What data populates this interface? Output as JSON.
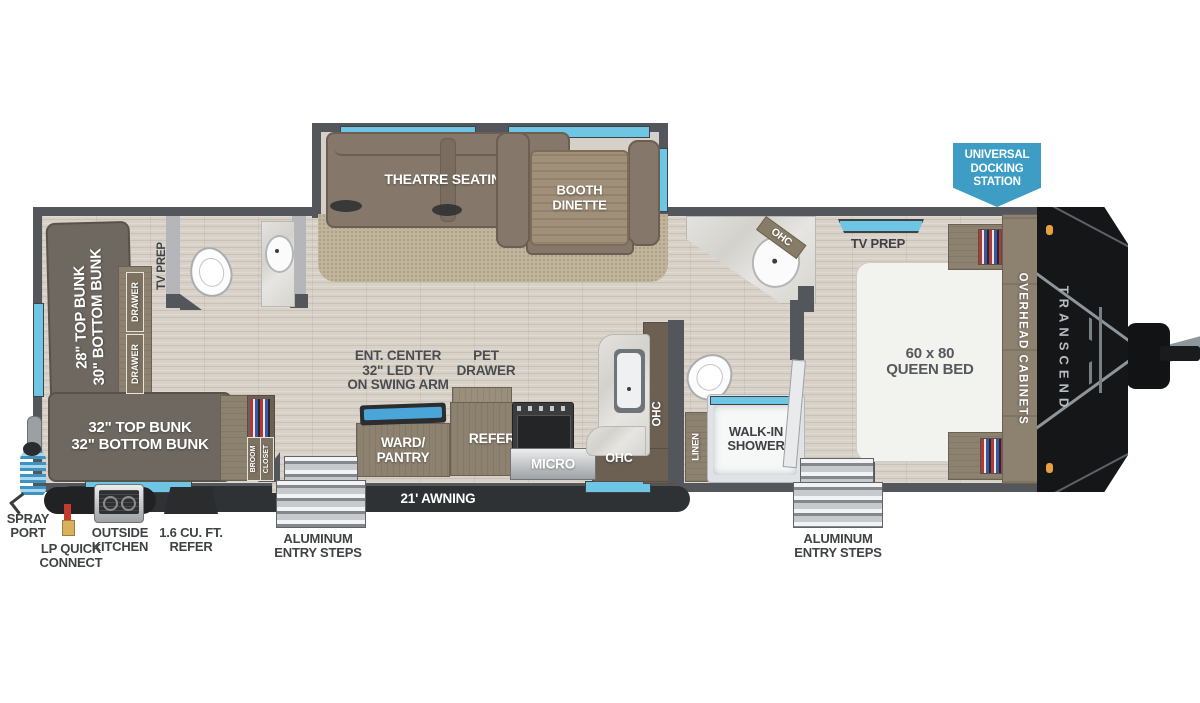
{
  "title": "Transcend travel trailer floor plan",
  "colors": {
    "wall": "#53565a",
    "window_glass": "#6ec6e4",
    "awning_bar": "#2f3235",
    "badge_blue": "#3e9dc4",
    "floor": "#d8d1c8",
    "carpet": "#c0b49b",
    "furniture_brown": "#85786a",
    "label_text": "#3f4245"
  },
  "labels": {
    "theatre": "THEATRE SEATING",
    "dinette_l1": "BOOTH",
    "dinette_l2": "DINETTE",
    "bunk_rear_l1": "28\" TOP BUNK",
    "bunk_rear_l2": "30\" BOTTOM BUNK",
    "drawer_a": "DRAWER",
    "drawer_b": "DRAWER",
    "tv_prep_rear": "TV PREP",
    "bunk32_l1": "32\" TOP BUNK",
    "bunk32_l2": "32\" BOTTOM BUNK",
    "broom": "BROOM",
    "closet": "CLOSET",
    "ent_l1": "ENT. CENTER",
    "ent_l2": "32\" LED TV",
    "ent_l3": "ON SWING ARM",
    "pet_l1": "PET",
    "pet_l2": "DRAWER",
    "ward_l1": "WARD/",
    "ward_l2": "PANTRY",
    "refer": "REFER",
    "micro": "MICRO",
    "ohc_kitchen_side": "OHC",
    "ohc_kitchen_bottom": "OHC",
    "ohc_bath": "OHC",
    "linen": "LINEN",
    "shower_l1": "WALK-IN",
    "shower_l2": "SHOWER",
    "bed_l1": "60 x 80",
    "bed_l2": "QUEEN BED",
    "overhead_cabinets": "OVERHEAD CABINETS",
    "tv_prep_bed": "TV PREP",
    "brand": "TRANSCEND",
    "badge_l1": "UNIVERSAL",
    "badge_l2": "DOCKING",
    "badge_l3": "STATION",
    "awning": "21' AWNING",
    "steps_left_l1": "ALUMINUM",
    "steps_left_l2": "ENTRY STEPS",
    "steps_right_l1": "ALUMINUM",
    "steps_right_l2": "ENTRY STEPS",
    "spray_l1": "SPRAY",
    "spray_l2": "PORT",
    "lp_l1": "LP QUICK",
    "lp_l2": "CONNECT",
    "outside_l1": "OUTSIDE",
    "outside_l2": "KITCHEN",
    "refer_out_l1": "1.6 CU. FT.",
    "refer_out_l2": "REFER"
  }
}
